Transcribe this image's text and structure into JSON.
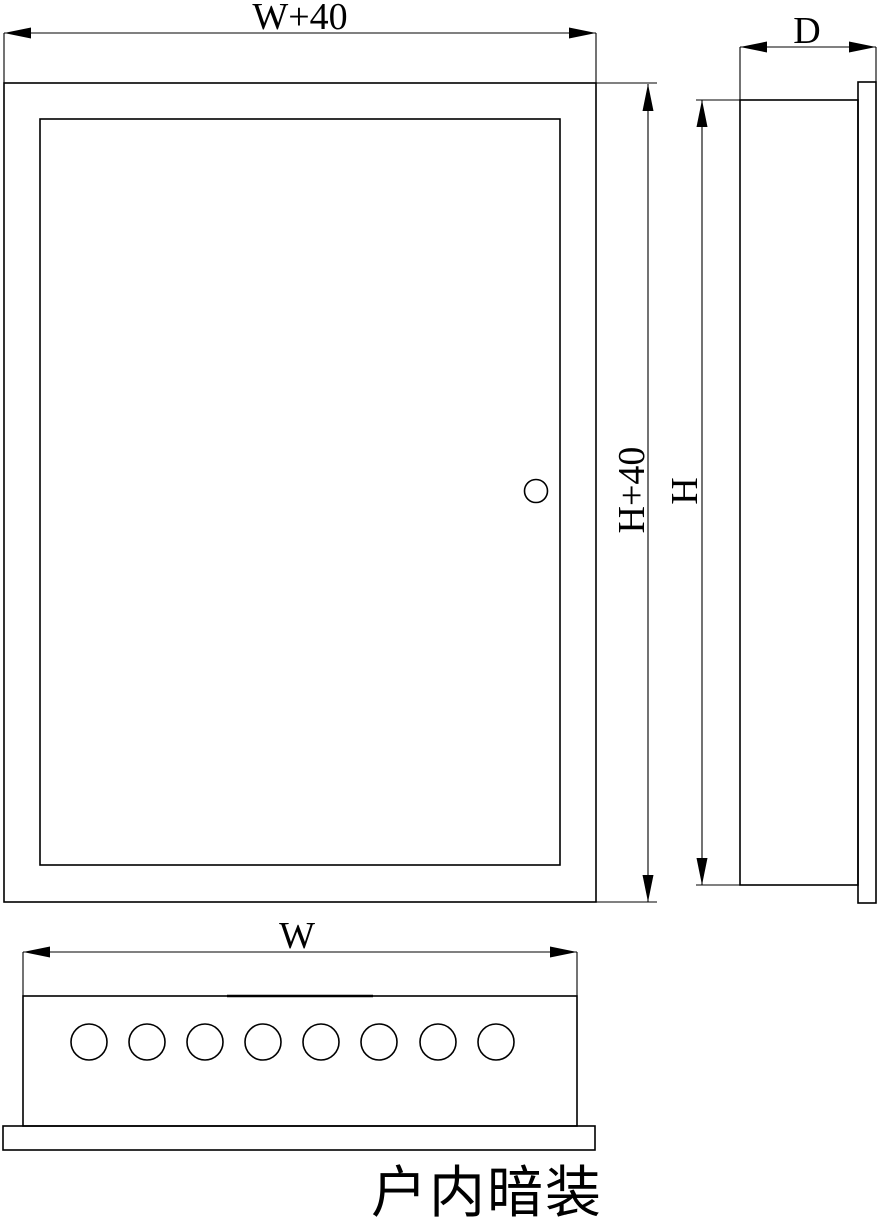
{
  "drawing": {
    "title": "户内暗装",
    "front_view": {
      "name": "front-view",
      "width_label": "W+40",
      "height_label": "H+40"
    },
    "side_view": {
      "name": "side-view",
      "depth_label": "D",
      "height_label": "H"
    },
    "bottom_view": {
      "name": "bottom-view",
      "width_label": "W",
      "knockout_hole_count": 8
    },
    "colors": {
      "line": "#000000",
      "background": "#ffffff"
    }
  }
}
